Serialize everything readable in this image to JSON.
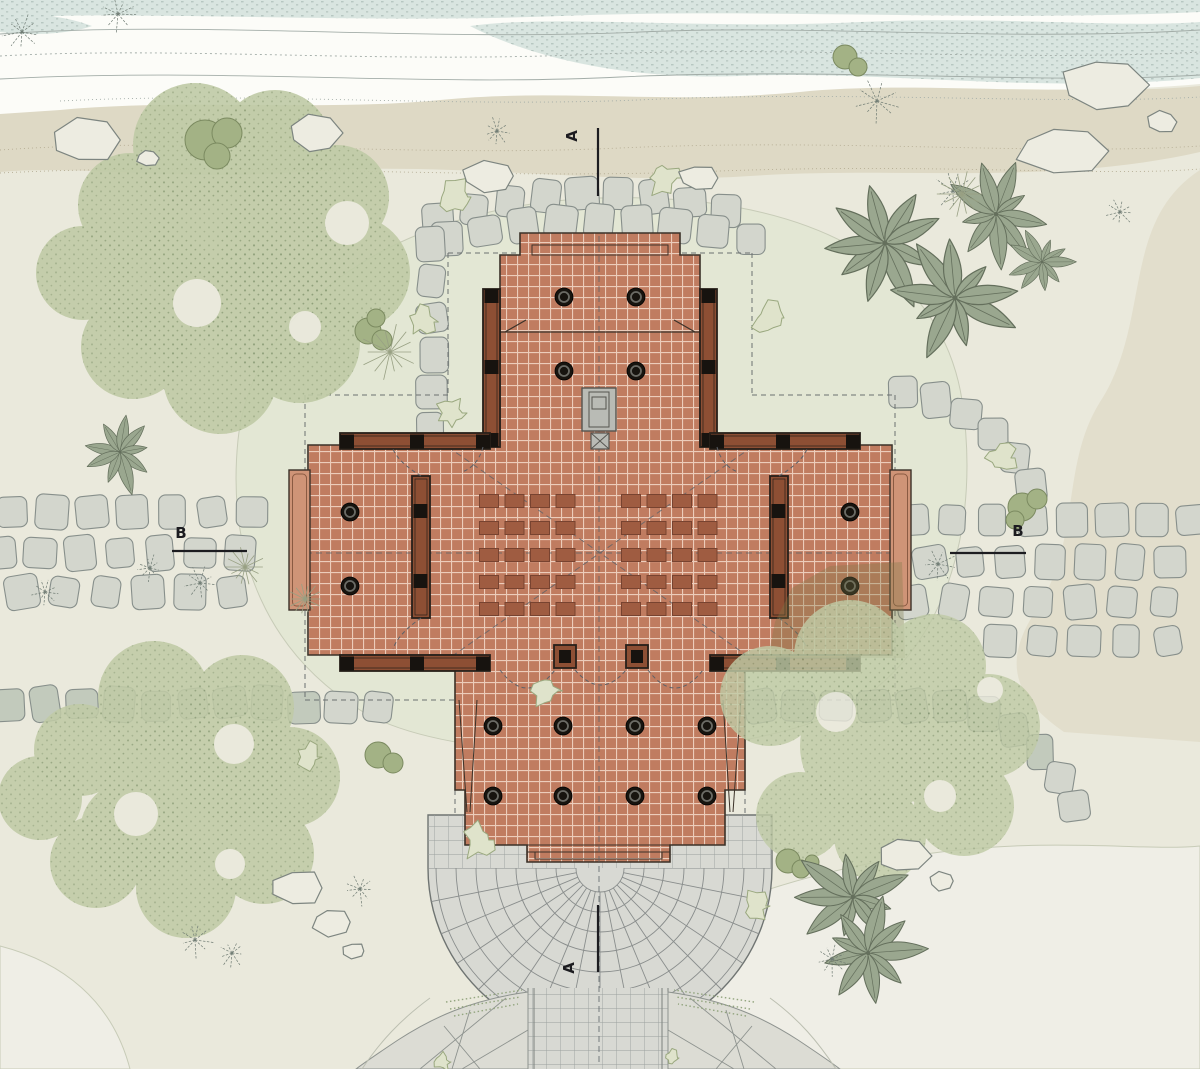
{
  "drawing": {
    "title": "temple-site-plan",
    "type": "architectural-site-plan",
    "section_markers": {
      "a_top": "A",
      "a_bottom": "A",
      "b_left": "B",
      "b_right": "B"
    }
  },
  "building": {
    "prayer_mats": {
      "blocks": 2,
      "rows": 5,
      "cols": 4
    },
    "columns": {
      "entry_porch": 8,
      "side_wings": 4,
      "sanctum": 4
    },
    "features": [
      "central-altar",
      "entry-steps",
      "radial-plaza",
      "verandas",
      "screen-walls"
    ]
  },
  "palette": {
    "paper": "#eae9dc",
    "riverWhite": "#fcfcf8",
    "water": "#d9e5e0",
    "waterDot": "#aebfb9",
    "flowLine": "#a3ada8",
    "sand": "#ded9c5",
    "sandLine": "#b6ae95",
    "ground": "#e3e7d4",
    "groundEdge": "#c7cbb7",
    "pale": "#efeee6",
    "tan": "#e0dcc9",
    "canopy": "#c0cba6",
    "canopyDot": "#85976f",
    "bushFill": "#a3b285",
    "bushEdge": "#7b8a60",
    "scraggleFill": "#dfe3cb",
    "scraggleEdge": "#9aa87f",
    "fern": "#6f7b73",
    "star": "#98a083",
    "stone": "#d3d6cd",
    "stoneDark": "#c2cabc",
    "stoneEdge": "#878f8b",
    "rockFill": "#edece1",
    "rockEdge": "#7d8580",
    "tile": "#c07c60",
    "grout": "#ecccba",
    "outline": "#3b3128",
    "wall": "#8d4f34",
    "wallEdge": "#27201a",
    "post": "#17130f",
    "columnFill": "#17140f",
    "columnRing": "#6b6b65",
    "mat": "#9f5c41",
    "matEdge": "#784330",
    "altar": "#b9bbb5",
    "altarEdge": "#55544f",
    "plaza": "#d8d9d3",
    "plazaLine": "#898d8c",
    "plazaEdge": "#6f7472",
    "slab": "#dcdcd4",
    "slabLine": "#8e938f",
    "marker": "#1c1c20",
    "centerline": "#5c6168",
    "boundary": "#6b7070",
    "shadow": "rgba(125,120,72,0.33)",
    "hatch": "#93a57f",
    "veranda": "#cf9477",
    "verandaEdge": "#8a5a42"
  }
}
